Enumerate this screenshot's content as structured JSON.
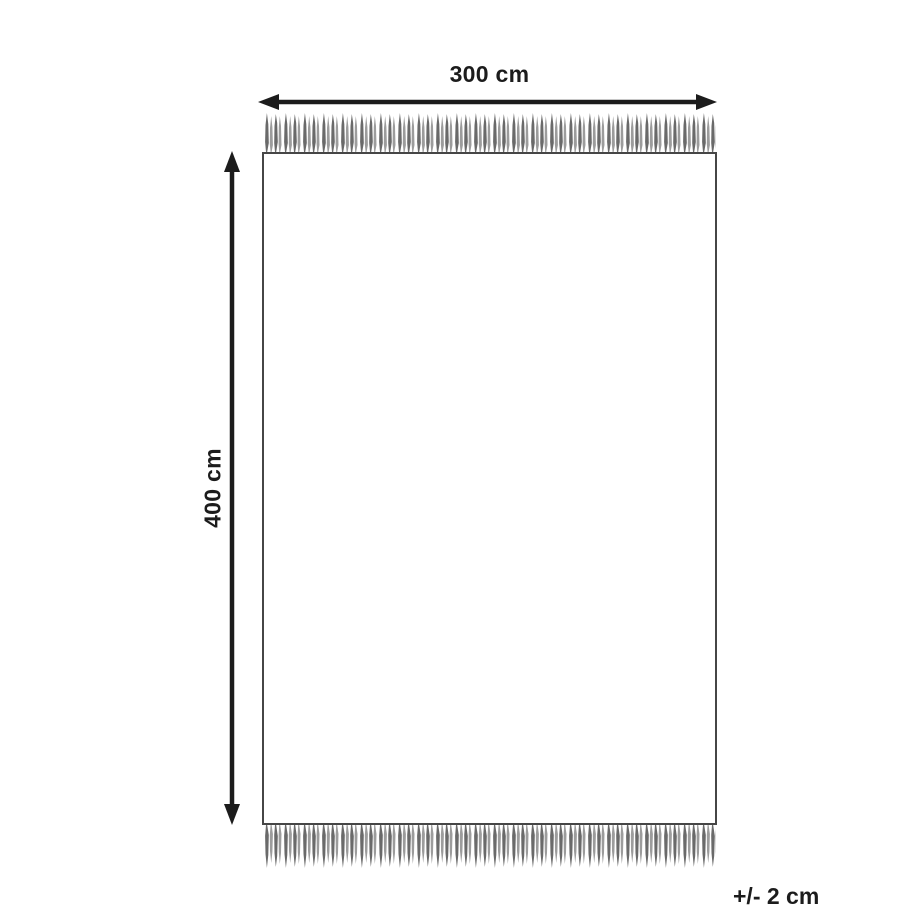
{
  "diagram": {
    "width_label": "300 cm",
    "height_label": "400 cm",
    "tolerance_label": "+/- 2 cm",
    "colors": {
      "background": "#ffffff",
      "line": "#1c1c1c",
      "outline": "#464646",
      "fringe_dark": "#6a6a6a",
      "fringe_light": "#9c9c9c"
    }
  }
}
